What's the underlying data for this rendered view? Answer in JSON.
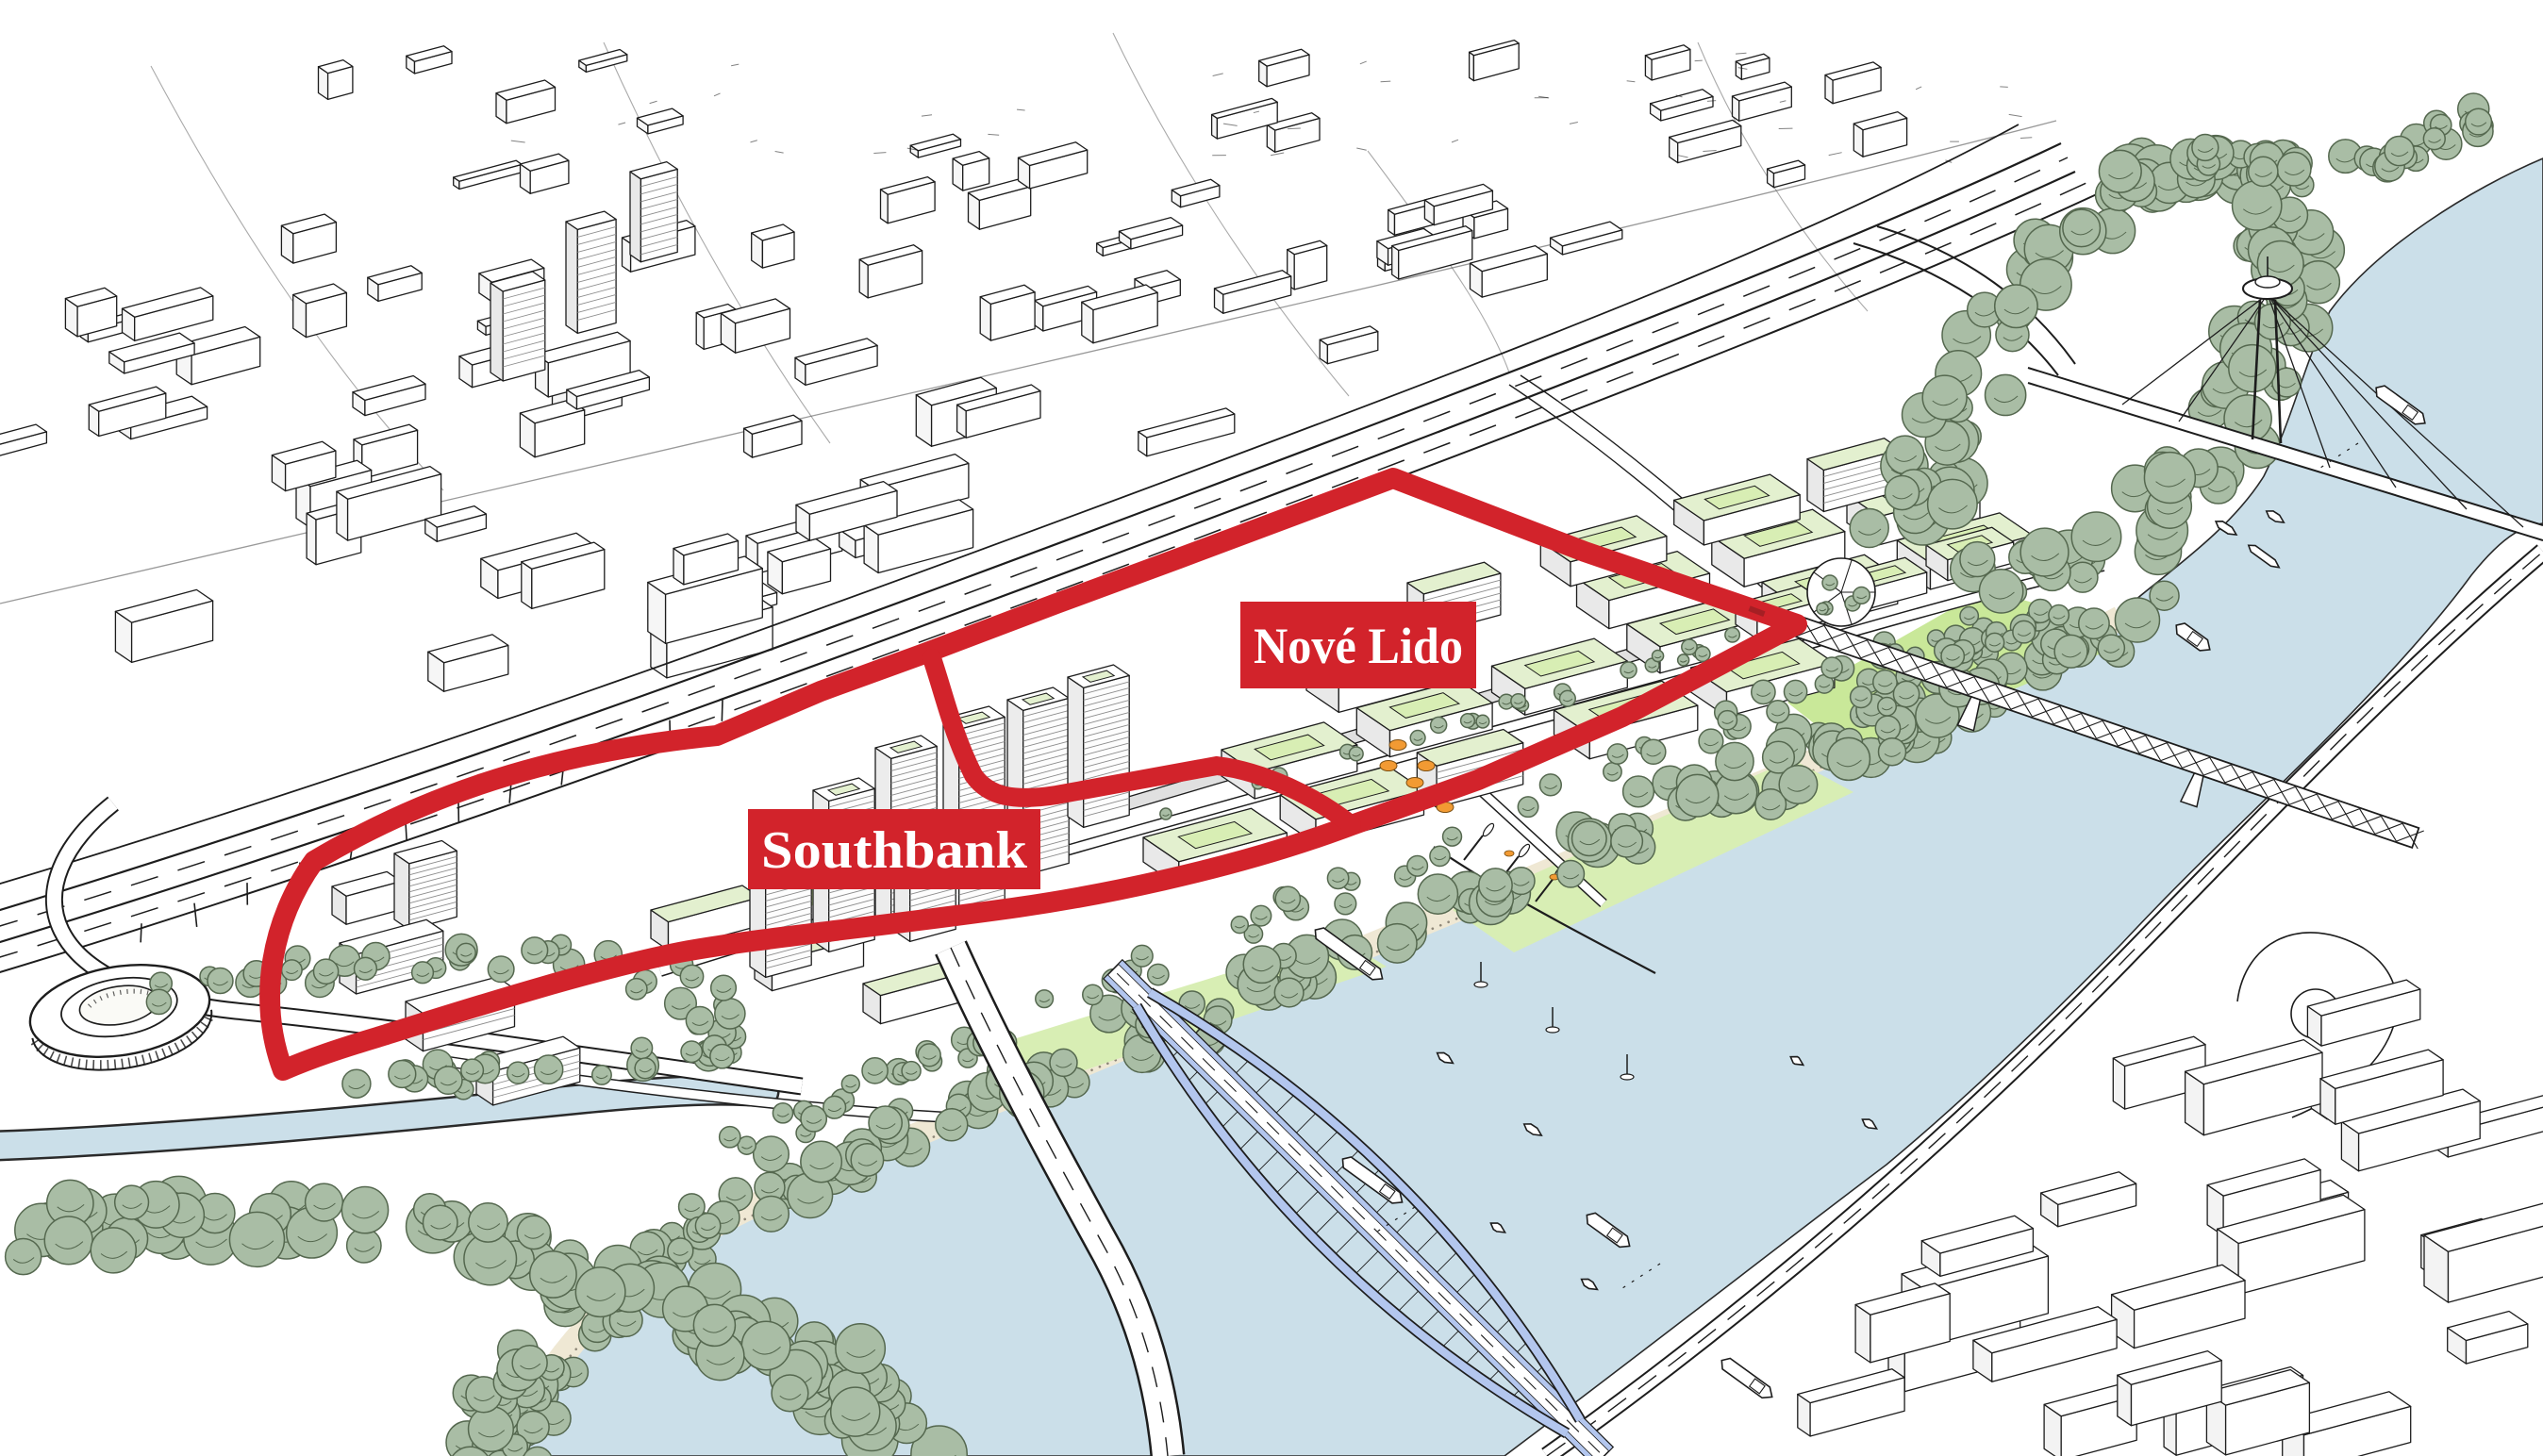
{
  "illustration": {
    "type": "urban-masterplan-aerial-sketch",
    "labels": {
      "nove_lido": "Nové Lido",
      "southbank": "Southbank"
    },
    "colors": {
      "outline_red": "#d2232b",
      "tram_red": "#a51f24",
      "label_text": "#ffffff",
      "river": "#cbdfe9",
      "channel": "#cbdfe9",
      "bridge_blue": "#b3c6ee",
      "tree": "#a9bda5",
      "tree_outline": "#55684f",
      "lawn": "#d8eeb4",
      "lawn_bright": "#c9e899",
      "roof_green": "#e3f0cf",
      "sand": "#efe8d4",
      "ink": "#1d1d1d",
      "shade": "#ececec",
      "orange": "#f29a33",
      "background": "#ffffff"
    }
  }
}
